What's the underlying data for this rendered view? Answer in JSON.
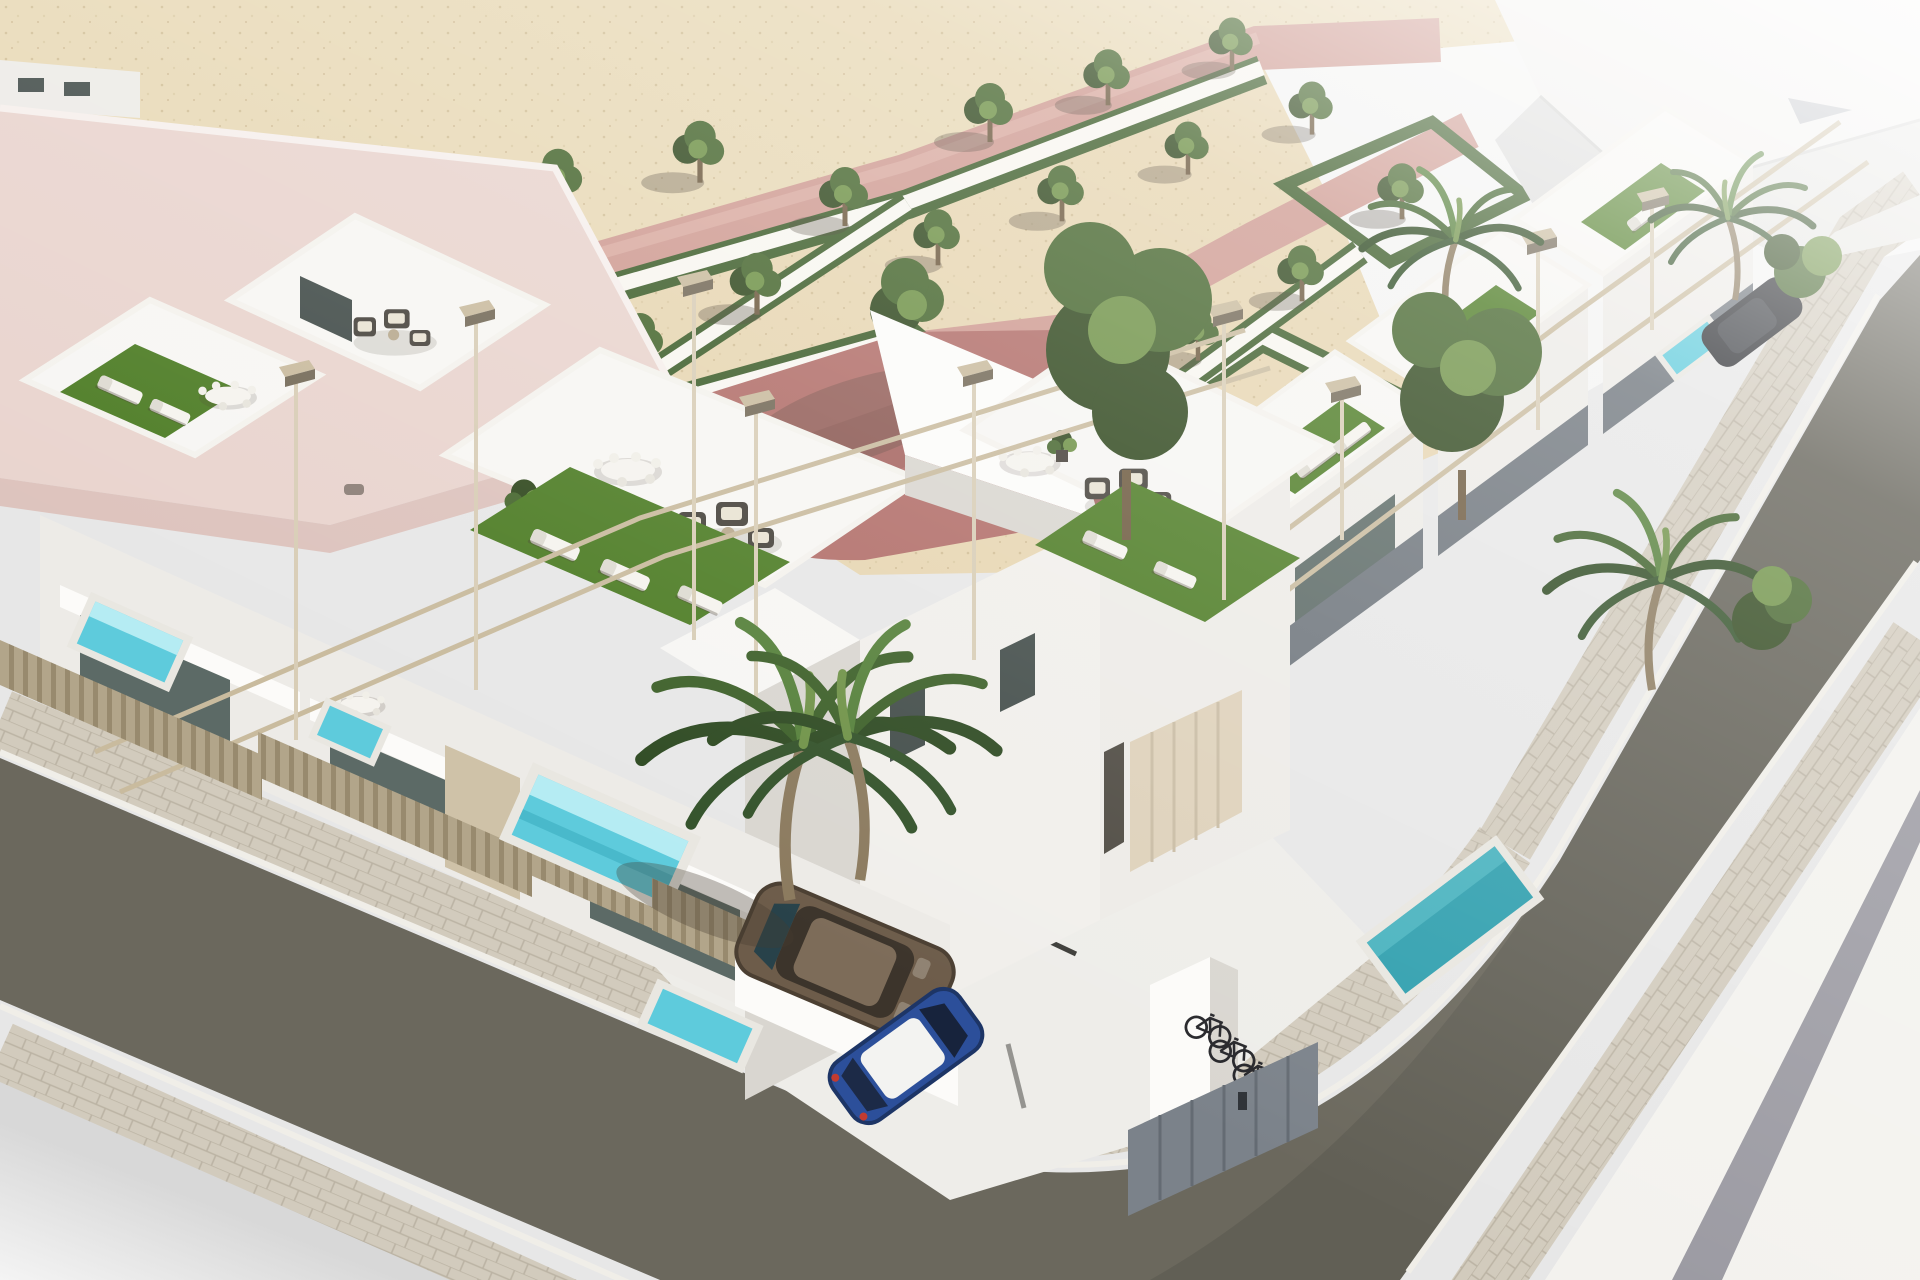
{
  "image": {
    "type": "3d-architectural-rendering",
    "subject": "Aerial 3D render of a modern white residential complex: two rows of townhouses with rooftop terraces (artificial turf, sun loungers, rattan sofas, pergolas), private plunge pools behind slatted fences, a formal park with zigzag hedges and rose-pink promenades, a street corner with cobbled sidewalks, parked cars, palm trees and a bicycle shelter",
    "view": "isometric aerial"
  },
  "palette": {
    "bgGray": "#e7e7e7",
    "bgGrayDark": "#d3d3d5",
    "sand": "#e8d9b6",
    "parkGravel": "#e7d6b2",
    "pathWhite": "#f8f6f0",
    "pinkPath": "#cf9b92",
    "pinkLight": "#ddb1a7",
    "plazaRose": "#b26f6a",
    "plazaDark": "#9c5c59",
    "hedge": "#3f5f2c",
    "treeGreen": "#47672f",
    "treeLight": "#6f9247",
    "treeDark": "#31491f",
    "trunk": "#6e5b40",
    "roofPink": "#e9d4ce",
    "roofShade": "#ddc3bd",
    "whiteTop": "#f7f6f3",
    "whiteLit": "#fcfbf9",
    "wallLight": "#edebe7",
    "wallMid": "#d9d6d0",
    "wallDark": "#c0bdb6",
    "wallDeep": "#a7a49d",
    "glass": "#5c6a66",
    "glassDark": "#434d4a",
    "glassLight": "#87918d",
    "turf": "#4e7d26",
    "turfLight": "#63942f",
    "poolAqua": "#5ecbdc",
    "poolLight": "#b5ecf3",
    "poolTeal": "#2f9fae",
    "fence": "#b2a58a",
    "fenceDark": "#8f8164",
    "pergola": "#c9bb9e",
    "pergolaDark": "#746a58",
    "sofa": "#47433c",
    "cushion": "#e9e3d3",
    "lounger": "#f5f3ee",
    "asphalt": "#6b685d",
    "asphaltDark": "#5a574e",
    "sidewalk": "#d2cbbd",
    "sidewalkLine": "#b5ad9d",
    "curb": "#f0eee8",
    "pavement": "#f3f2ee",
    "wallBand": "#9a99a1",
    "carBrown": "#6d5c4a",
    "carBrownDark": "#4b3f32",
    "carBlue": "#2c4f9a",
    "carBlueDark": "#1d3566",
    "carRoof": "#f3f3f1",
    "carBlack": "#2a2c30",
    "bike": "#26262a",
    "shed": "#7b828a",
    "shadow": "rgba(70,62,48,0.33)"
  },
  "scene": {
    "park": {
      "trees": 20,
      "large_trees": 3,
      "hedge_pattern": "zigzag parterre",
      "promenade_color_key": "pinkPath"
    },
    "buildings": {
      "left_row_units": 5,
      "right_row_units": 4,
      "corner_unit": 1,
      "rooftop_terraces": 8,
      "pergolas": "beige frames"
    },
    "pools": {
      "front_yard_pools": 5,
      "teal_pools": 2
    },
    "vehicles": [
      {
        "type": "hatchback",
        "color_key": "carBrown",
        "location": "walled parking nook"
      },
      {
        "type": "hatchback",
        "color_key": "carBlue",
        "roof": "white",
        "location": "parking bay"
      },
      {
        "type": "car",
        "color_key": "carBlack",
        "location": "right street"
      }
    ],
    "bicycles": 3,
    "palm_trees": 6,
    "streets": {
      "left": "diagonal, cobbled sidewalks",
      "right": "dark asphalt, curved corner"
    }
  }
}
